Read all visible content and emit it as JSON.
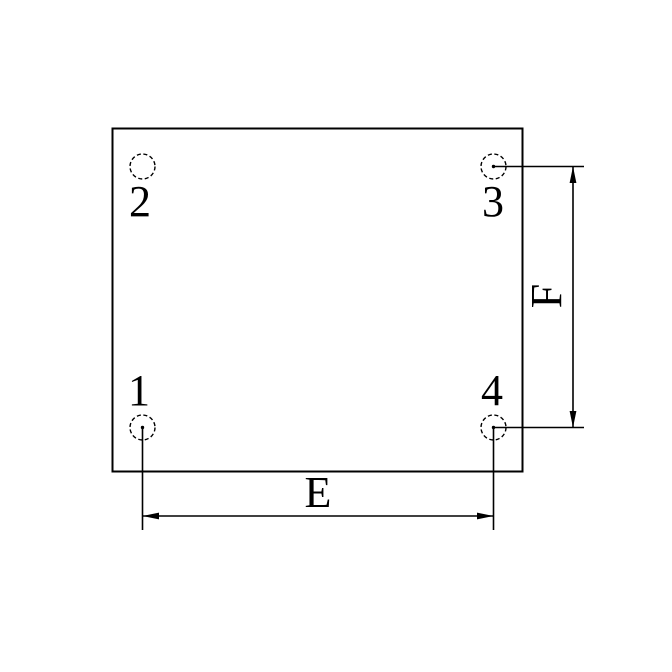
{
  "drawing": {
    "pad_labels": {
      "pad1": "1",
      "pad2": "2",
      "pad3": "3",
      "pad4": "4"
    },
    "dimension_labels": {
      "horizontal": "E",
      "vertical": "F"
    }
  },
  "colors": {
    "line": "#000000",
    "background": "#ffffff"
  }
}
